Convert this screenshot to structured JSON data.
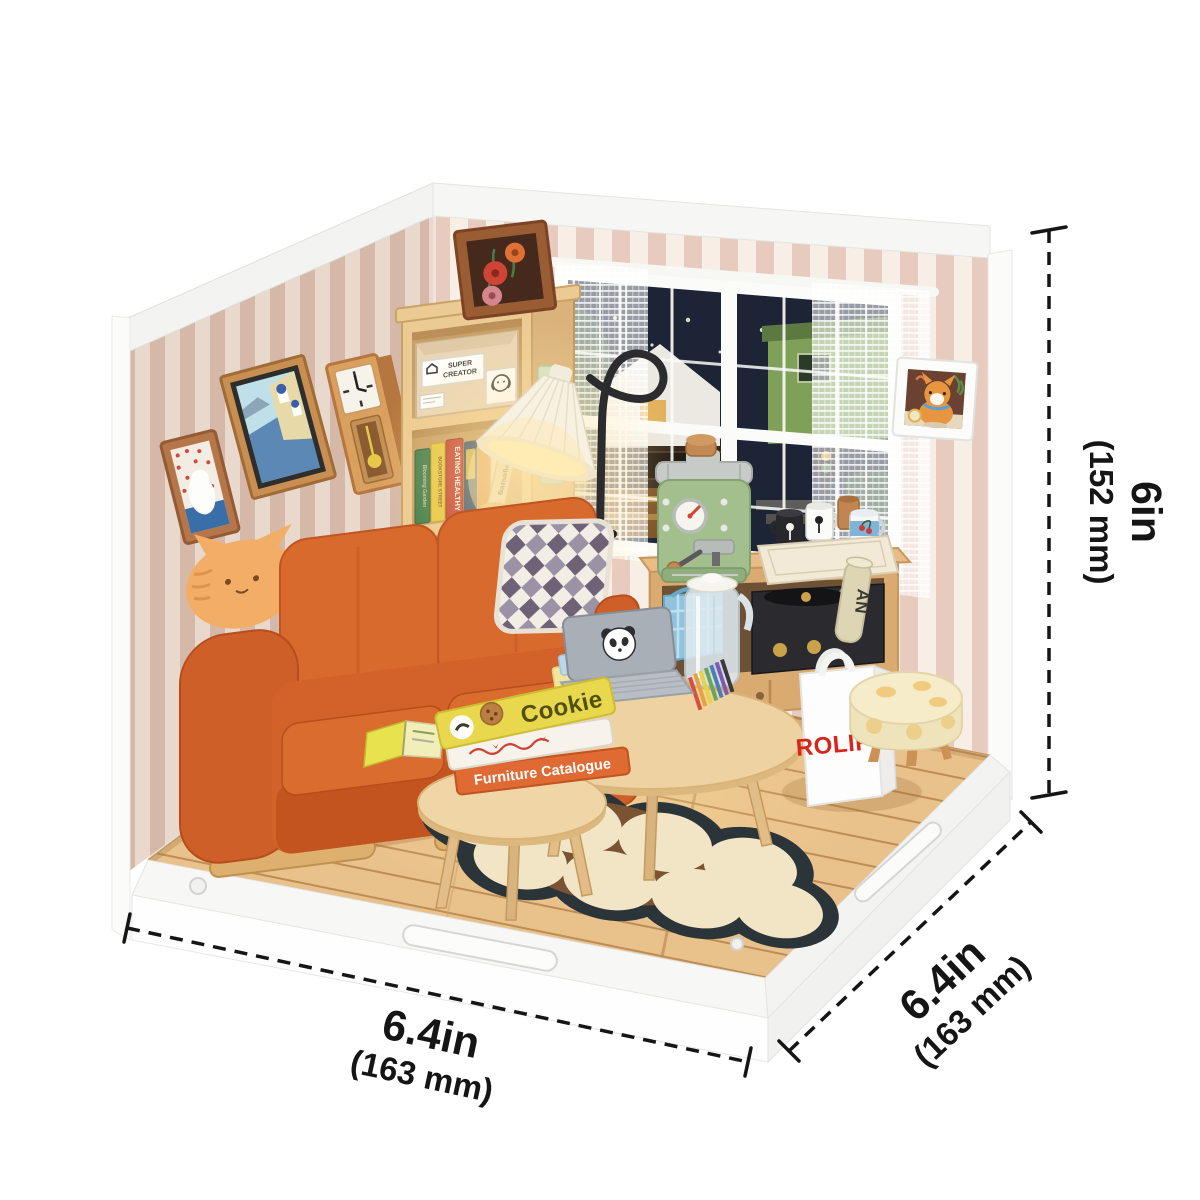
{
  "dimensions": {
    "height": {
      "in": "6in",
      "mm": "(152 mm)"
    },
    "front": {
      "in": "6.4in",
      "mm": "(163 mm)"
    },
    "side": {
      "in": "6.4in",
      "mm": "(163 mm)"
    }
  },
  "scene": {
    "box_label_line1": "SUPER",
    "box_label_line2": "CREATOR",
    "bag_text": "ROLIFE",
    "poster_text": "AN",
    "window_sign": "I COFF",
    "books": {
      "blooming_garden": "Blooming Garden",
      "bookstore_street": "BOOKSTORE STREET",
      "eating_healthy": "EATING HEALTHY",
      "organizing": "Organizing",
      "on_the_road": "ON THE ROAD",
      "seven_good_habits": "7 GOOD HABITS",
      "super_creator": "SUPER CREATOR",
      "cookie": "Cookie",
      "furniture_catalogue": "Furniture Catalogue"
    }
  },
  "colors": {
    "accent_red": "#d8251c",
    "sofa_orange": "#d2622a",
    "machine_green": "#a3bf8e",
    "floor_wood": "#e9c28b",
    "stripe_pink": "#e4c9bc",
    "rug_dark": "#2b3438",
    "lamp_glow": "#ffe2a0"
  }
}
